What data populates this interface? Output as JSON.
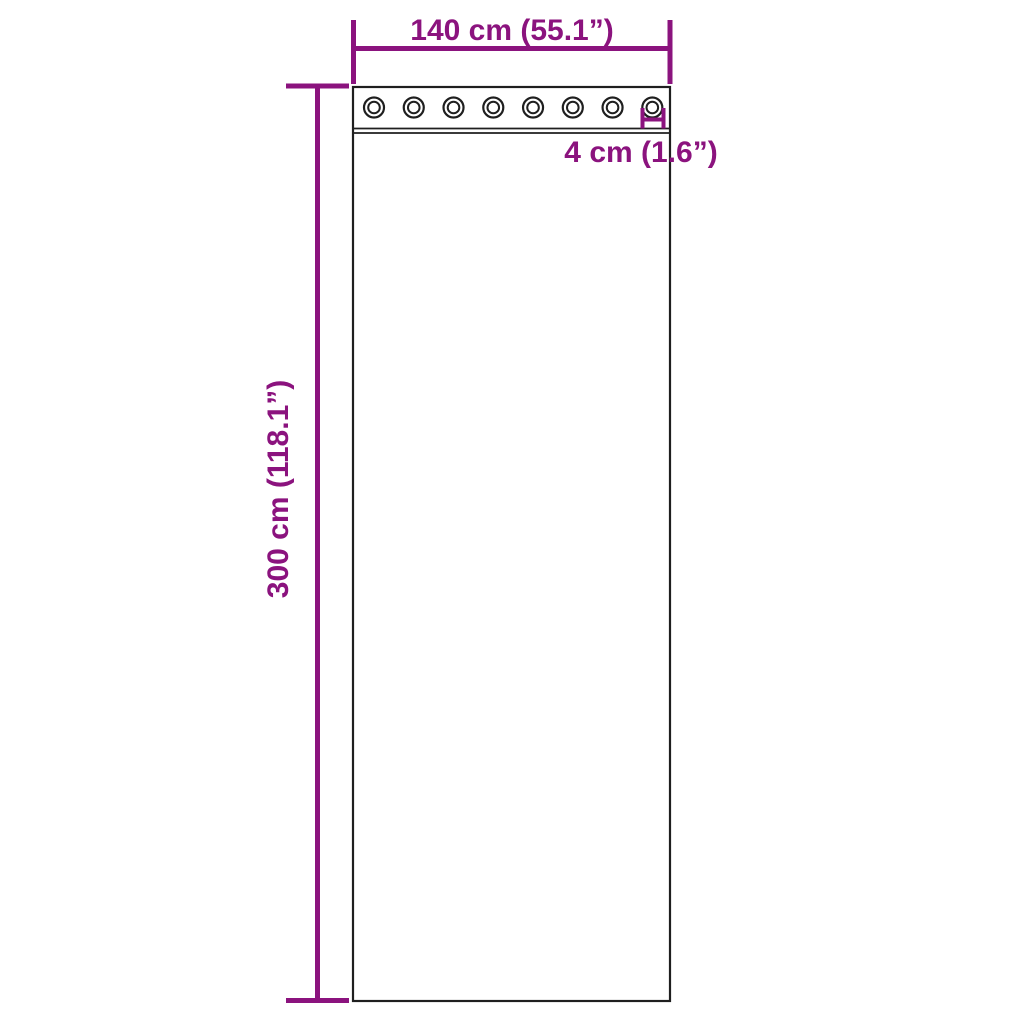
{
  "title": "Curtain dimension diagram",
  "colors": {
    "dimension_annotation": "#8B137E",
    "outline": "#1F1F1F",
    "background": "#FFFFFF"
  },
  "curtain": {
    "grommet_count": 8,
    "width_label": "140 cm (55.1”)",
    "height_label": "300 cm (118.1”)",
    "grommet_diameter_label": "4 cm (1.6”)"
  }
}
